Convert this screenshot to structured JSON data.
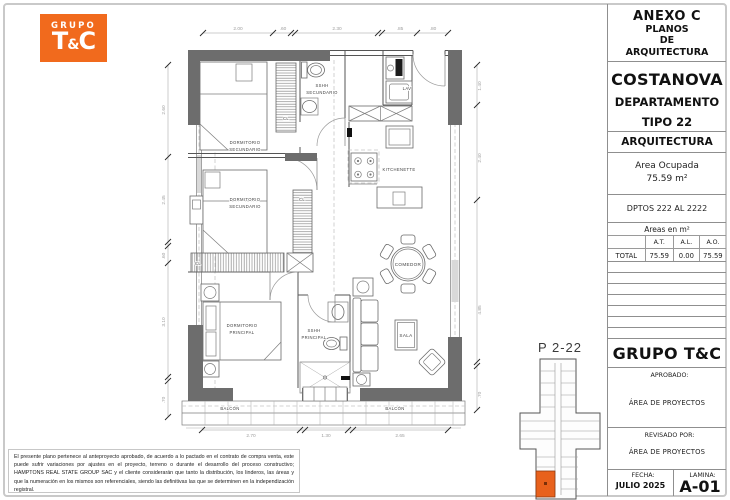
{
  "logo": {
    "grupo": "GRUPO",
    "brand_t": "T",
    "brand_amp": "&",
    "brand_c": "C",
    "bg_color": "#F16A1D",
    "text_color": "#ffffff"
  },
  "title_block": {
    "annex_title": "ANEXO C",
    "annex_sub1": "PLANOS",
    "annex_sub2": "DE",
    "annex_sub3": "ARQUITECTURA",
    "project_name": "COSTANOVA",
    "unit_line1": "DEPARTAMENTO",
    "unit_line2": "TIPO 22",
    "discipline": "ARQUITECTURA",
    "area_label": "Area Ocupada",
    "area_value": "75.59 m²",
    "dptos_range": "DPTOS 222 AL 2222",
    "areas_table": {
      "title": "Areas en m²",
      "columns": [
        "",
        "A.T.",
        "A.L.",
        "A.O."
      ],
      "rows": [
        [
          "TOTAL",
          "75.59",
          "0.00",
          "75.59"
        ]
      ]
    },
    "company": "GRUPO T&C",
    "approved_label": "APROBADO:",
    "approved_value": "ÁREA DE PROYECTOS",
    "reviewed_label": "REVISADO POR:",
    "reviewed_value": "ÁREA DE PROYECTOS",
    "date_label": "FECHA:",
    "date_value": "JULIO 2025",
    "sheet_label": "LAMINA:",
    "sheet_number": "A-01"
  },
  "key_plan": {
    "title": "P 2-22",
    "highlight_color": "#E8611C"
  },
  "plan": {
    "rooms": {
      "dormitorio": "DORMITORIO",
      "secundario": "SECUNDARIO",
      "principal": "PRINCIPAL",
      "sshh": "SSHH",
      "lav": "LAV",
      "kitchenette": "KITCHENETTE",
      "comedor": "COMEDOR",
      "sala": "SALA",
      "balcon": "BALCÓN",
      "closet": "CL"
    },
    "dimensions": {
      "top": [
        "2.00",
        ".60",
        "2.30",
        ".85",
        ".80"
      ],
      "bottom": [
        "2.70",
        "1.30",
        "2.65"
      ],
      "left": [
        "2.60",
        "2.45",
        ".60",
        "3.10",
        ".70"
      ],
      "right": [
        "1.40",
        "2.40",
        "4.85",
        ".70"
      ]
    },
    "wall_color": "#6d6d6d"
  },
  "disclaimer": "El presente plano pertenece al anteproyecto aprobado, de acuerdo a lo pactado en el contrato de compra venta, este puede sufrir variaciones por ajustes en el proyecto, terreno o durante el desarrollo del proceso constructivo; HAMPTONS REAL STATE GROUP SAC y el cliente considerarán que tanto la distribución, los linderos, las áreas y que la numeración en los mismos son referenciales, siendo las definitivas las que se determinen en la independización registral."
}
